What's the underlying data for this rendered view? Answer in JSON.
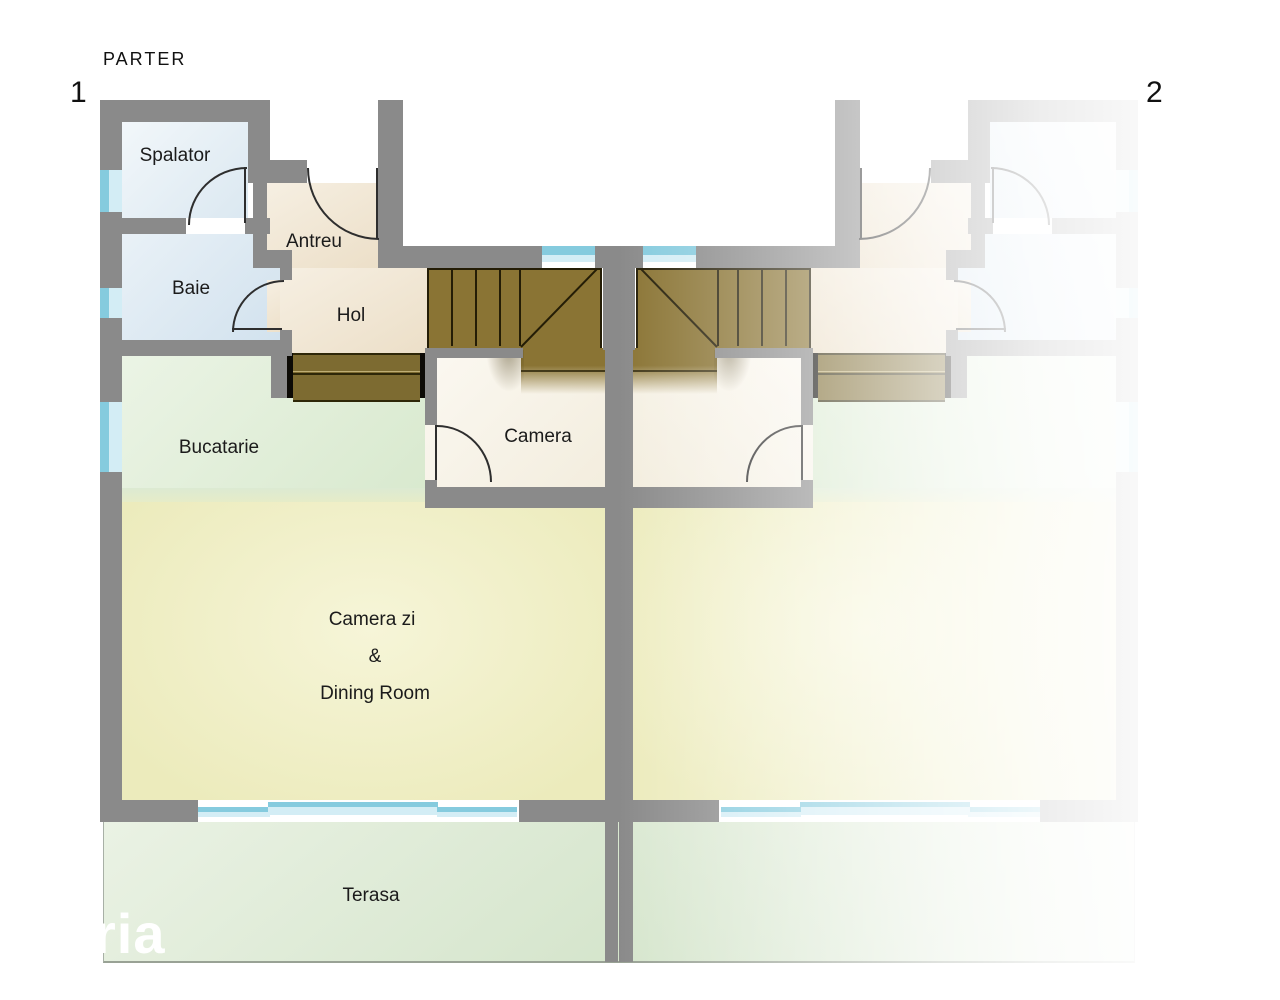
{
  "title": "PARTER",
  "units": [
    {
      "number": "1",
      "side": "left"
    },
    {
      "number": "2",
      "side": "right"
    }
  ],
  "rooms": [
    {
      "id": "spalator",
      "label": "Spalator"
    },
    {
      "id": "antreu",
      "label": "Antreu"
    },
    {
      "id": "baie",
      "label": "Baie"
    },
    {
      "id": "hol",
      "label": "Hol"
    },
    {
      "id": "bucatarie",
      "label": "Bucatarie"
    },
    {
      "id": "camera",
      "label": "Camera"
    },
    {
      "id": "living_dining",
      "label_lines": [
        "Camera zi",
        "&",
        "Dining Room"
      ]
    },
    {
      "id": "terasa",
      "label": "Terasa"
    }
  ],
  "watermark": "ria",
  "colors": {
    "wall": "#8a8a8a",
    "stairs_wood": "#8a7434",
    "window_glass": "#85cbde",
    "window_glass_light": "#d3edf5",
    "room_blue": "#dce9f2",
    "room_beige": "#f2ead9",
    "room_green": "#e0edd7",
    "room_yellow": "#f1f0c9",
    "room_cream": "#f7f3e9",
    "terrace_green": "#dfead7"
  }
}
